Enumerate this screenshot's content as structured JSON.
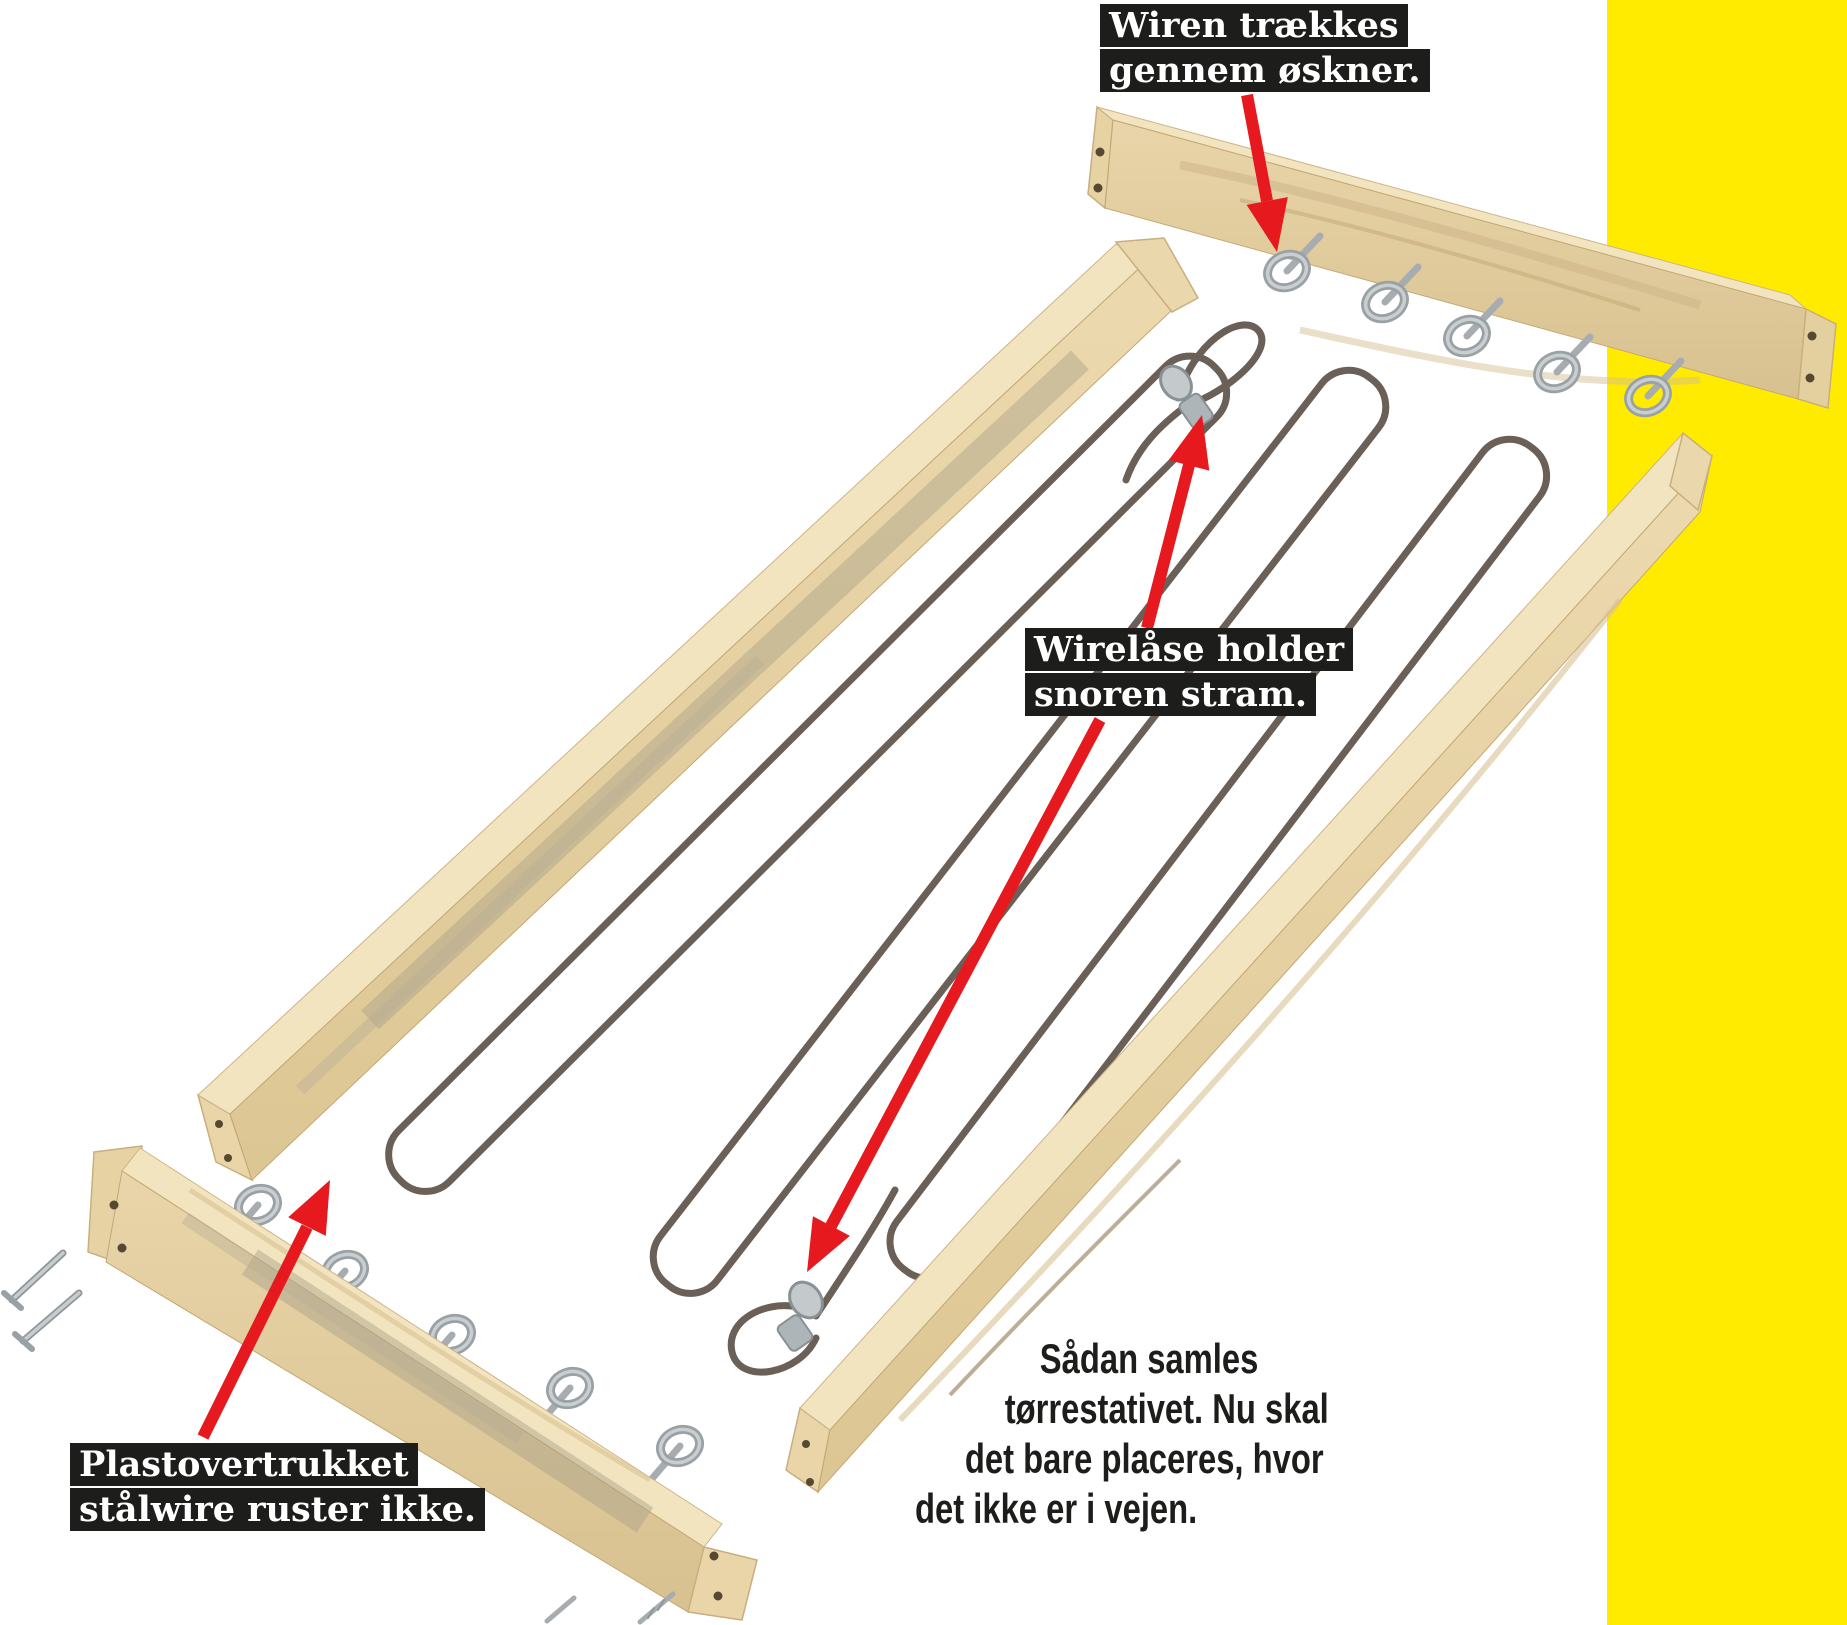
{
  "colors": {
    "background": "#ffffff",
    "yellow_stripe": "#FFEB00",
    "arrow_red": "#E5191E",
    "label_bg": "#1D1D1B",
    "label_text": "#FFFFFF",
    "caption_text": "#1D1D1B",
    "wood_face": "#E3CDA0",
    "wood_top": "#F2E4BE",
    "wire": "#6A6057",
    "steel": "#AEB4B7"
  },
  "callouts": {
    "wire_through_eyes": {
      "line1": "Wiren trækkes",
      "line2": "gennem øskner."
    },
    "wire_locks": {
      "line1": "Wirelåse holder",
      "line2": "snoren stram."
    },
    "plastic_wire": {
      "line1": "Plastovertrukket",
      "line2": "stålwire ruster ikke."
    }
  },
  "caption": {
    "line1": "Sådan samles",
    "line2": "tørrestativet. Nu skal",
    "line3": "det bare placeres, hvor",
    "line4": "det ikke er i vejen."
  }
}
